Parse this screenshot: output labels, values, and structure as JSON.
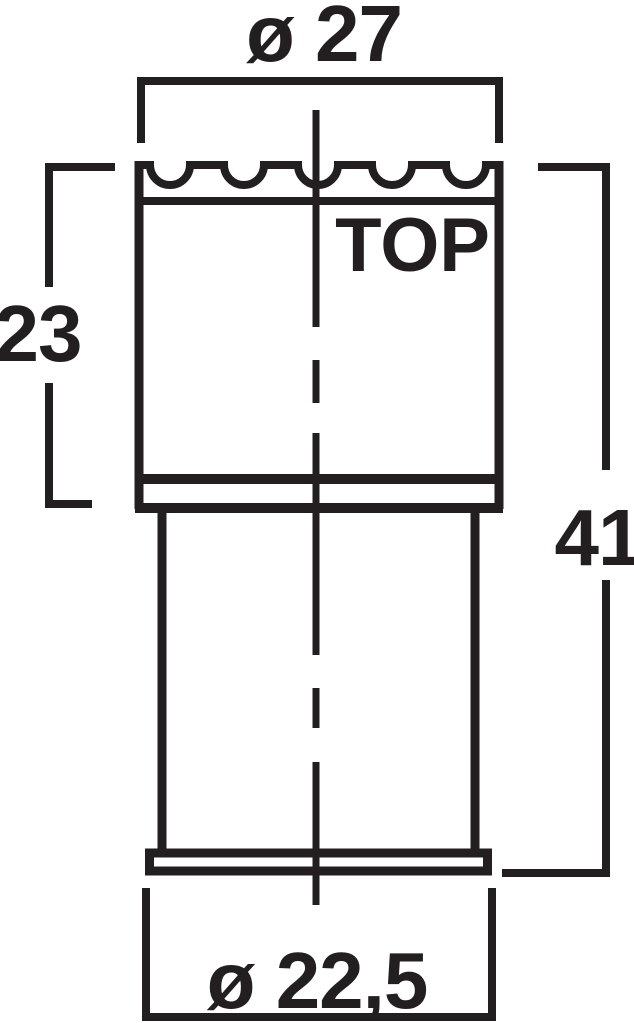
{
  "colors": {
    "line": "#231f20",
    "background": "#ffffff"
  },
  "drawing": {
    "part_label": "TOP",
    "dimensions": {
      "top_diameter": "ø 27",
      "upper_section_height": "23",
      "overall_height": "41",
      "base_diameter": "ø 22,5"
    }
  }
}
